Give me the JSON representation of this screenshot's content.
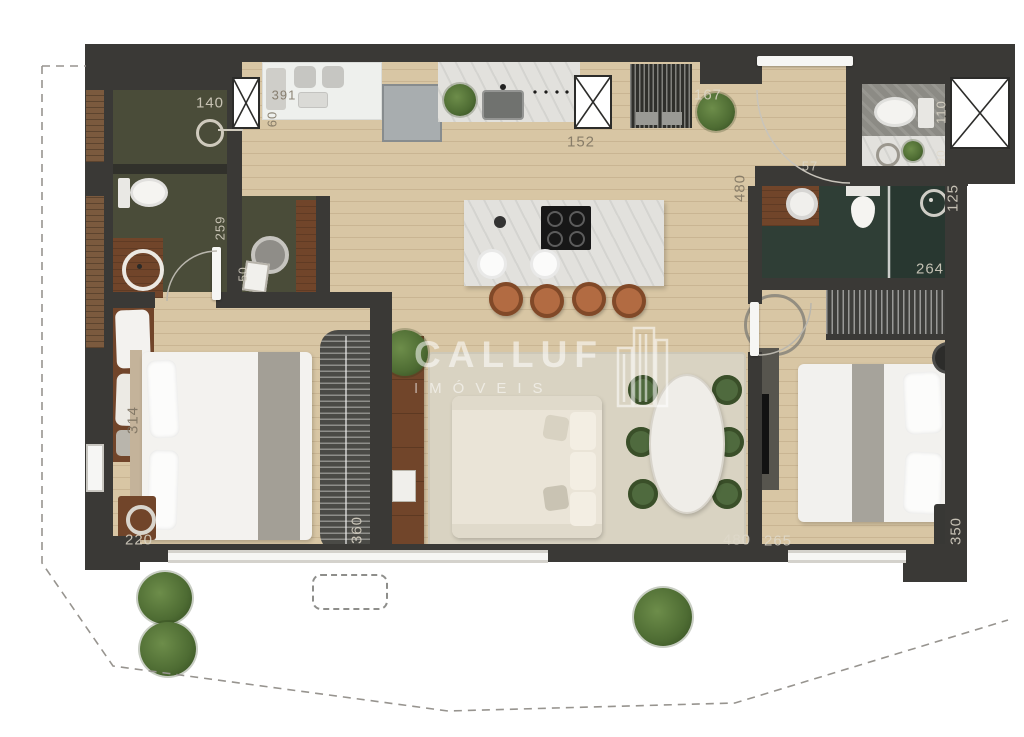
{
  "watermark": {
    "line1": "CALLUF",
    "line2": "IMÓVEIS"
  },
  "dimension_labels": [
    {
      "text": "140",
      "x": 210,
      "y": 103,
      "rot": 0,
      "tone": "light"
    },
    {
      "text": "391",
      "x": 284,
      "y": 95,
      "rot": 0,
      "tone": "dark",
      "s": 13
    },
    {
      "text": "60",
      "x": 272,
      "y": 119,
      "rot": 90,
      "tone": "dark",
      "s": 13
    },
    {
      "text": "152",
      "x": 581,
      "y": 142,
      "rot": 0,
      "tone": "dark"
    },
    {
      "text": "167",
      "x": 708,
      "y": 95,
      "rot": 0,
      "tone": "light"
    },
    {
      "text": "480",
      "x": 740,
      "y": 188,
      "rot": 90,
      "tone": "dark"
    },
    {
      "text": "110",
      "x": 941,
      "y": 112,
      "rot": 90,
      "tone": "light",
      "s": 13
    },
    {
      "text": "90",
      "x": 941,
      "y": 157,
      "rot": 90,
      "tone": "light",
      "s": 12
    },
    {
      "text": "57",
      "x": 810,
      "y": 166,
      "rot": 0,
      "tone": "light",
      "s": 13
    },
    {
      "text": "125",
      "x": 953,
      "y": 198,
      "rot": 90,
      "tone": "light"
    },
    {
      "text": "264",
      "x": 930,
      "y": 269,
      "rot": 0,
      "tone": "light"
    },
    {
      "text": "259",
      "x": 220,
      "y": 228,
      "rot": 90,
      "tone": "light",
      "s": 13
    },
    {
      "text": "50",
      "x": 243,
      "y": 274,
      "rot": 90,
      "tone": "light",
      "s": 12
    },
    {
      "text": "314",
      "x": 133,
      "y": 420,
      "rot": 90,
      "tone": "dark"
    },
    {
      "text": "220",
      "x": 139,
      "y": 540,
      "rot": 0,
      "tone": "light"
    },
    {
      "text": "360",
      "x": 357,
      "y": 530,
      "rot": 90,
      "tone": "light"
    },
    {
      "text": "480",
      "x": 737,
      "y": 540,
      "rot": 0,
      "tone": "light"
    },
    {
      "text": "265",
      "x": 778,
      "y": 541,
      "rot": 0,
      "tone": "light"
    },
    {
      "text": "350",
      "x": 956,
      "y": 531,
      "rot": 90,
      "tone": "light"
    }
  ],
  "colors": {
    "wall": "#3a3936",
    "wood": "#d8c6a4",
    "olive": "#4a4c39",
    "teal": "#2f3e36",
    "stone": "#8c8b85",
    "marble": "#e2e1dd",
    "counter": "#eef0ed",
    "terrace": "#eef0ef",
    "tile_line": "rgba(140,150,144,0.45)",
    "rug": "#d9d3c2",
    "sofa": "#eae4d7",
    "chair_green": "#4f6a3e",
    "plant": "#4e6c33",
    "stool": "#b26b42",
    "wood_furn": "#71452a",
    "white": "#f6f6f4",
    "dash": "#97948f",
    "label_light": "rgba(222,216,202,0.85)",
    "label_dark": "rgba(118,108,92,0.82)",
    "watermark": "rgba(255,255,255,0.55)"
  }
}
